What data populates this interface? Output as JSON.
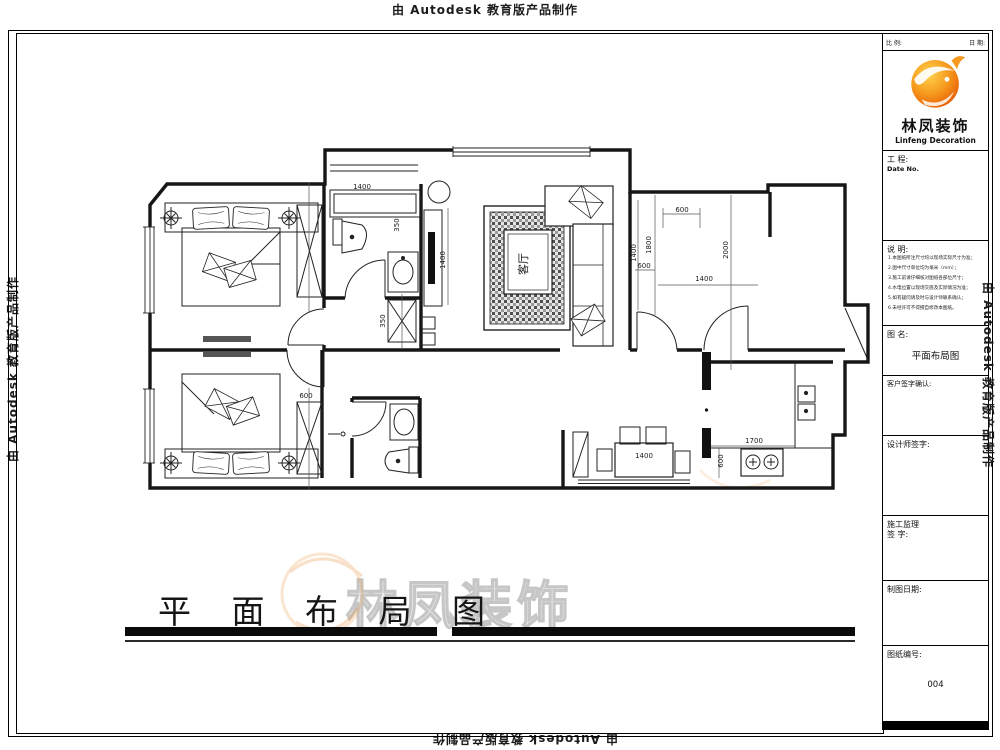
{
  "watermarks": {
    "autodesk_text": "由 Autodesk 教育版产品制作",
    "brand_outline_text": "林凤装饰"
  },
  "drawing": {
    "title": "平 面 布 局 图",
    "living_room_label": "客厅",
    "dims": {
      "bath_top": "1400",
      "tv_wall": "1400",
      "sofa_side": "1400",
      "bed3_top": "600",
      "bed3_left": "1800",
      "bed3_inner": "600",
      "bed3_depth": "2000",
      "bed3_width": "1400",
      "dining_table": "1400",
      "kitchen_counter": "1700",
      "kitchen_side": "600",
      "wardrobe2": "600",
      "closet_a": "350",
      "closet_b": "350"
    }
  },
  "title_block": {
    "scale_label": "比 例:",
    "date_label": "日 期:",
    "logo": {
      "brand_cn": "林凤装饰",
      "brand_en": "Linfeng Decoration"
    },
    "project_label": "工 程:",
    "project_value": "Date No.",
    "notes_label": "说 明:",
    "notes_lines": [
      "1.本图纸所注尺寸均以现场实际尺寸为准；",
      "2.图中尺寸单位均为毫米（mm）；",
      "3.施工前请仔细核对图纸各部位尺寸；",
      "4.水电位置以现场交底及实际情况为准；",
      "5.如有疑问请及时与设计师联系确认；",
      "6.未经许可不得擅自修改本图纸。"
    ],
    "name_label": "图 名:",
    "name_value": "平面布局图",
    "client_sign_label": "客户签字确认:",
    "designer_sign_label": "设计师签字:",
    "supervisor_line1": "施工监理",
    "supervisor_line2": "签 字:",
    "draw_date_label": "制图日期:",
    "sheet_no_label": "图纸编号:",
    "sheet_no_value": "004"
  }
}
